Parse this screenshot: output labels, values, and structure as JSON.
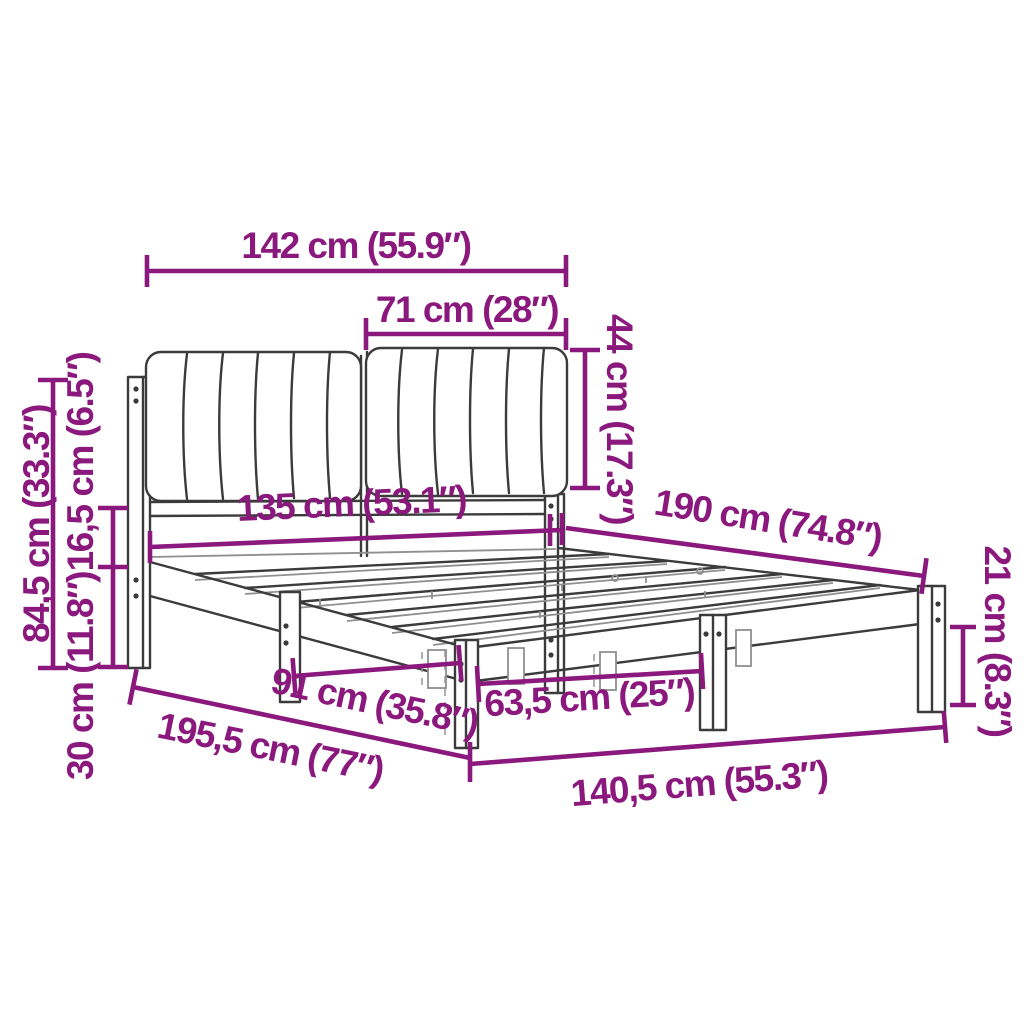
{
  "figure": {
    "name": "bed-frame-with-upholstered-headboard-dimension-diagram",
    "background_color": "#FFFFFF",
    "accent_color": "#8B187D",
    "drawing_line_color": "#3B3B3B"
  },
  "dimensions": {
    "headboard_width": "142 cm (55.9″)",
    "cushion_width": "71 cm (28″)",
    "cushion_height": "44 cm (17.3″)",
    "headboard_height": "84,5 cm (33.3″)",
    "rail_height": "16,5 cm (6.5″)",
    "under_bed_clearance": "30 cm (11.8″)",
    "inner_width": "135 cm (53.1″)",
    "inner_length": "190 cm (74.8″)",
    "leg_height": "21 cm (8.3″)",
    "leg_spacing_side": "91 cm (35.8″)",
    "leg_spacing_foot": "63,5 cm (25″)",
    "total_length": "195,5 cm (77″)",
    "total_width": "140,5 cm (55.3″)"
  }
}
